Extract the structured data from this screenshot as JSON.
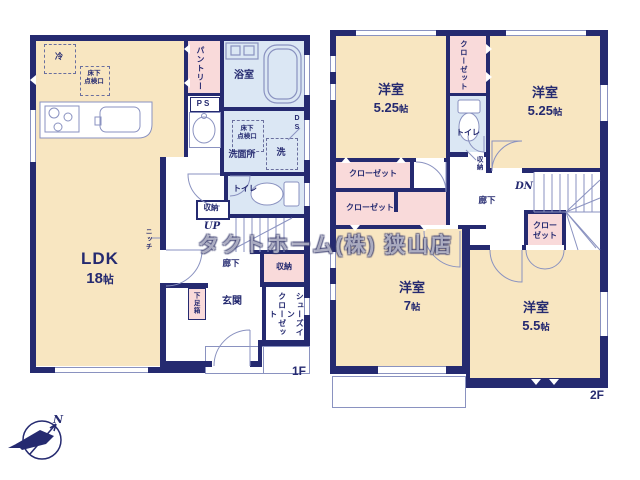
{
  "watermark": "タクトホーム(株) 狭山店",
  "compass": {
    "north_label": "N"
  },
  "colors": {
    "wall": "#252a70",
    "room_beige": "#f8e6c1",
    "closet_pink": "#f9dada",
    "wet_blue": "#dbe7f4",
    "line": "#8a92c0"
  },
  "f1": {
    "floor_label": "1F",
    "ldk": "LDK",
    "ldk_num": "18",
    "ldk_unit": "帖",
    "pantry": "パントリー",
    "ps": "PS",
    "bath": "浴室",
    "wash": "洗面所",
    "ds": "D\nS",
    "toilet": "トイレ",
    "storage_understairs": "収納",
    "up": "UP",
    "hall": "廊下",
    "niche": "ニッチ",
    "storage_entry": "収納",
    "sic": "シューズイン\nクローゼット",
    "entrance": "玄関",
    "shoebox": "下足箱",
    "fridge": "冷",
    "underfloor_hatch_kitchen": "床下\n点検口",
    "underfloor_hatch_wash": "床下\n点検口",
    "washer": "洗"
  },
  "f2": {
    "floor_label": "2F",
    "bedroom_tl": "洋室",
    "bedroom_tl_num": "5.25",
    "bedroom_tl_unit": "帖",
    "bedroom_tr": "洋室",
    "bedroom_tr_num": "5.25",
    "bedroom_tr_unit": "帖",
    "bedroom_bl": "洋室",
    "bedroom_bl_num": "7",
    "bedroom_bl_unit": "帖",
    "bedroom_br": "洋室",
    "bedroom_br_num": "5.5",
    "bedroom_br_unit": "帖",
    "closet_top": "クローゼット",
    "toilet": "トイレ",
    "storage": "収納",
    "closet_left_upper": "クローゼット",
    "closet_left_lower": "クローゼット",
    "closet_stairs": "クロー\nゼット",
    "hall": "廊下",
    "dn": "DN"
  }
}
